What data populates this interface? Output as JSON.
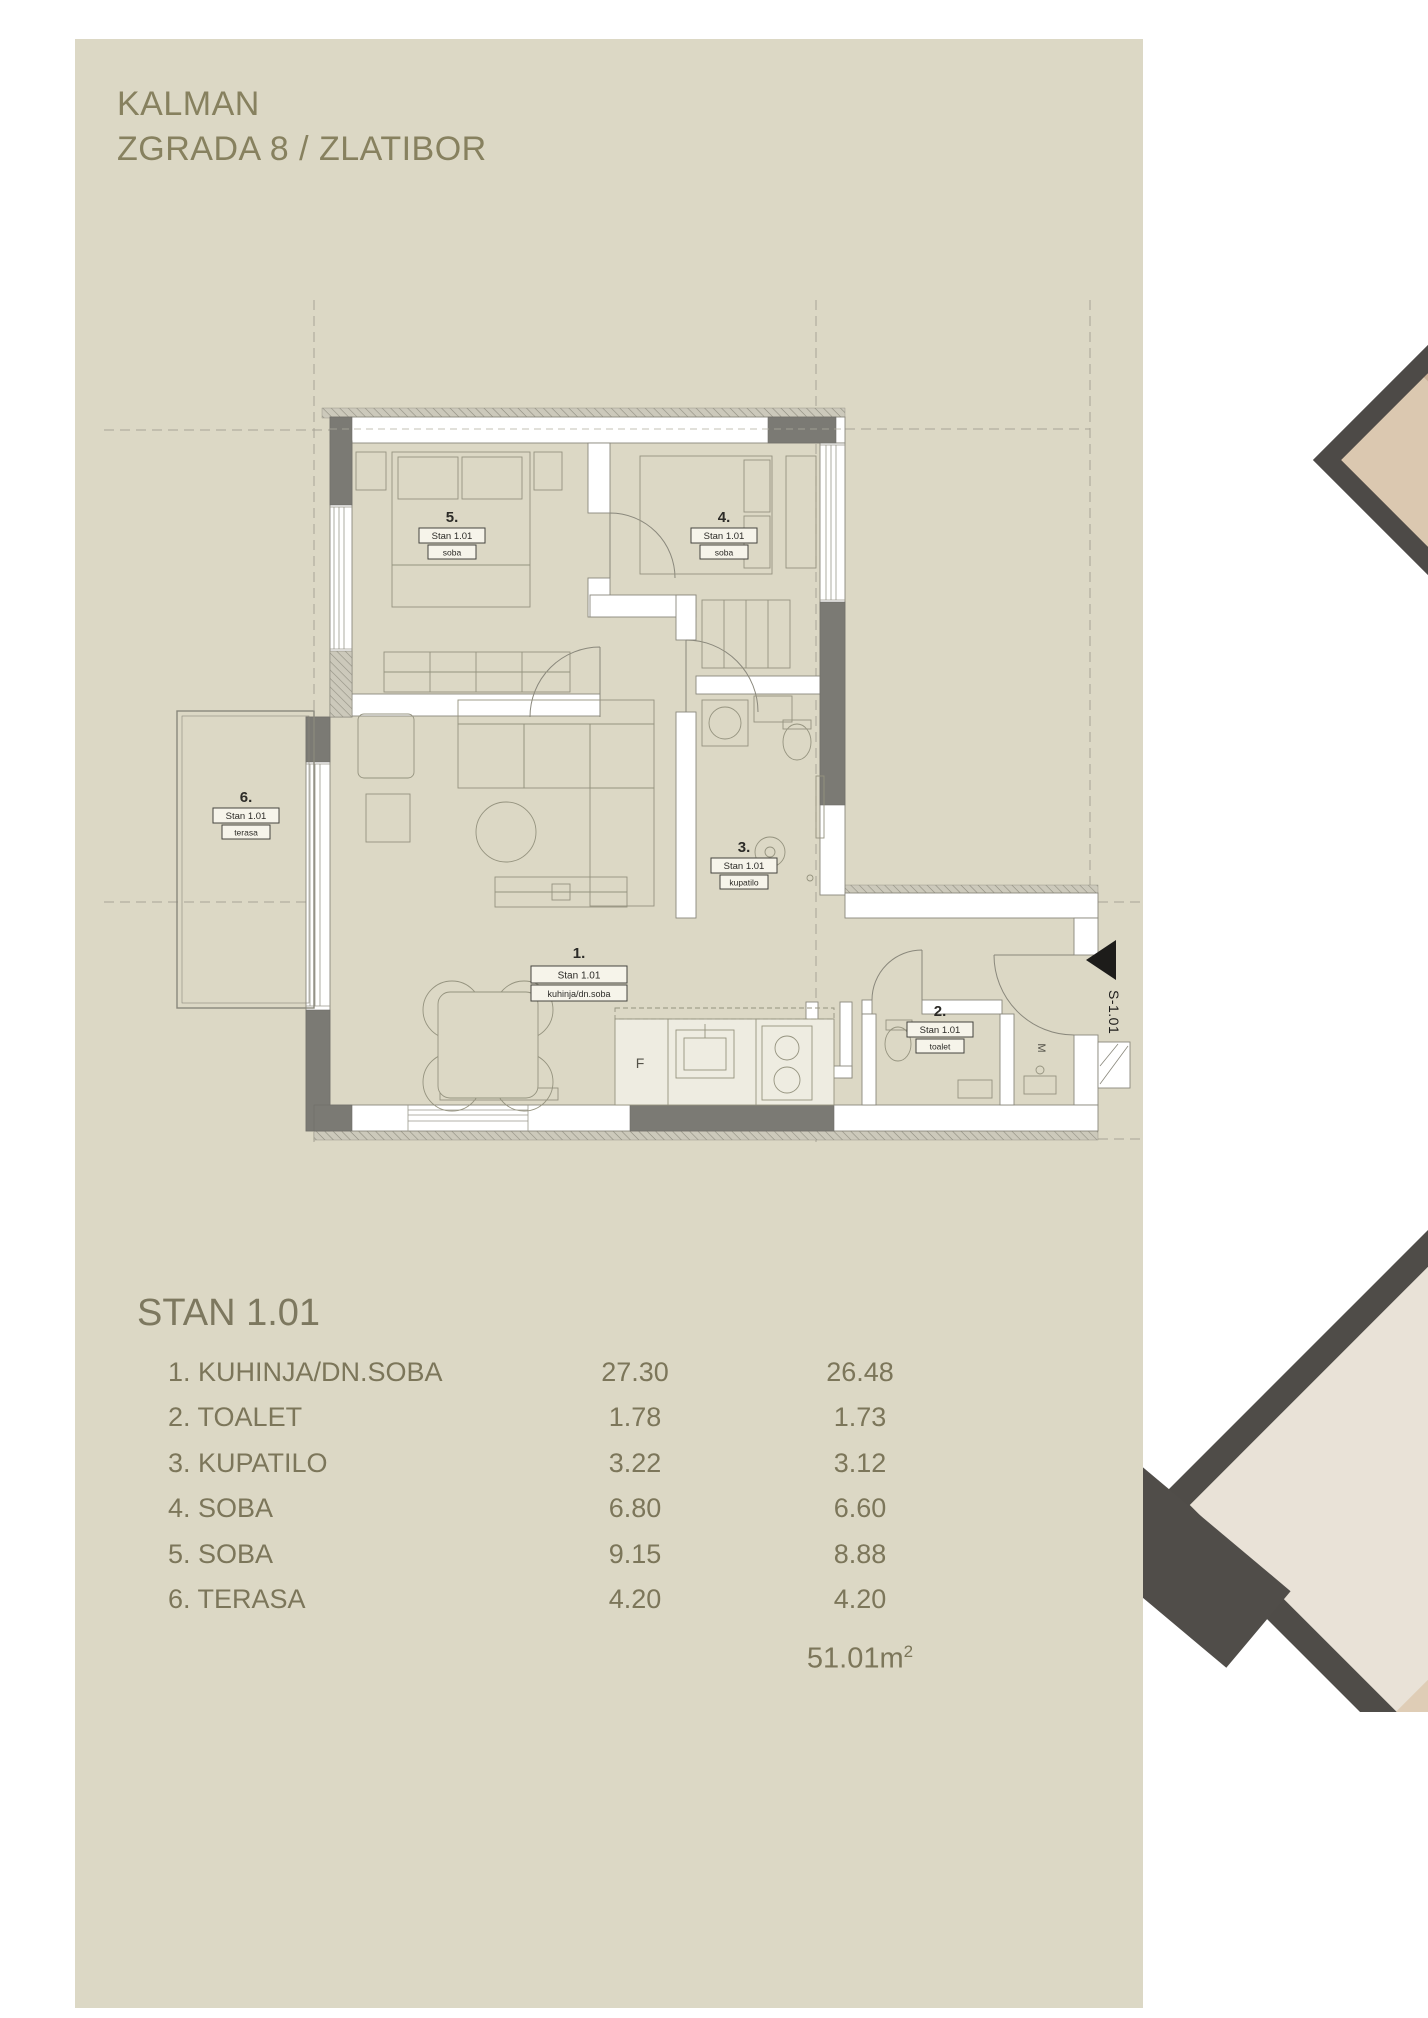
{
  "header": {
    "line1": "KALMAN",
    "line2": "ZGRADA 8 / ZLATIBOR"
  },
  "plan": {
    "rooms": [
      {
        "no": "1.",
        "unit": "Stan 1.01",
        "name": "kuhinja/dn.soba"
      },
      {
        "no": "2.",
        "unit": "Stan 1.01",
        "name": "toalet"
      },
      {
        "no": "3.",
        "unit": "Stan 1.01",
        "name": "kupatilo"
      },
      {
        "no": "4.",
        "unit": "Stan 1.01",
        "name": "soba"
      },
      {
        "no": "5.",
        "unit": "Stan 1.01",
        "name": "soba"
      },
      {
        "no": "6.",
        "unit": "Stan 1.01",
        "name": "terasa"
      }
    ],
    "entrance_marker": "S-1.01",
    "fridge_label": "F",
    "shaft_label": "M"
  },
  "table": {
    "title": "STAN 1.01",
    "rows": [
      {
        "label": "1. KUHINJA/DN.SOBA",
        "area": "27.30",
        "reduced": "26.48"
      },
      {
        "label": "2. TOALET",
        "area": "1.78",
        "reduced": "1.73"
      },
      {
        "label": "3. KUPATILO",
        "area": "3.22",
        "reduced": "3.12"
      },
      {
        "label": "4. SOBA",
        "area": "6.80",
        "reduced": "6.60"
      },
      {
        "label": "5. SOBA",
        "area": "9.15",
        "reduced": "8.88"
      },
      {
        "label": "6. TERASA",
        "area": "4.20",
        "reduced": "4.20"
      }
    ],
    "total": "51.01m",
    "total_sup": "2"
  },
  "colors": {
    "panel": "#dcd8c5",
    "accent_text": "#87815f",
    "plan_dark": "#7b7a74"
  }
}
